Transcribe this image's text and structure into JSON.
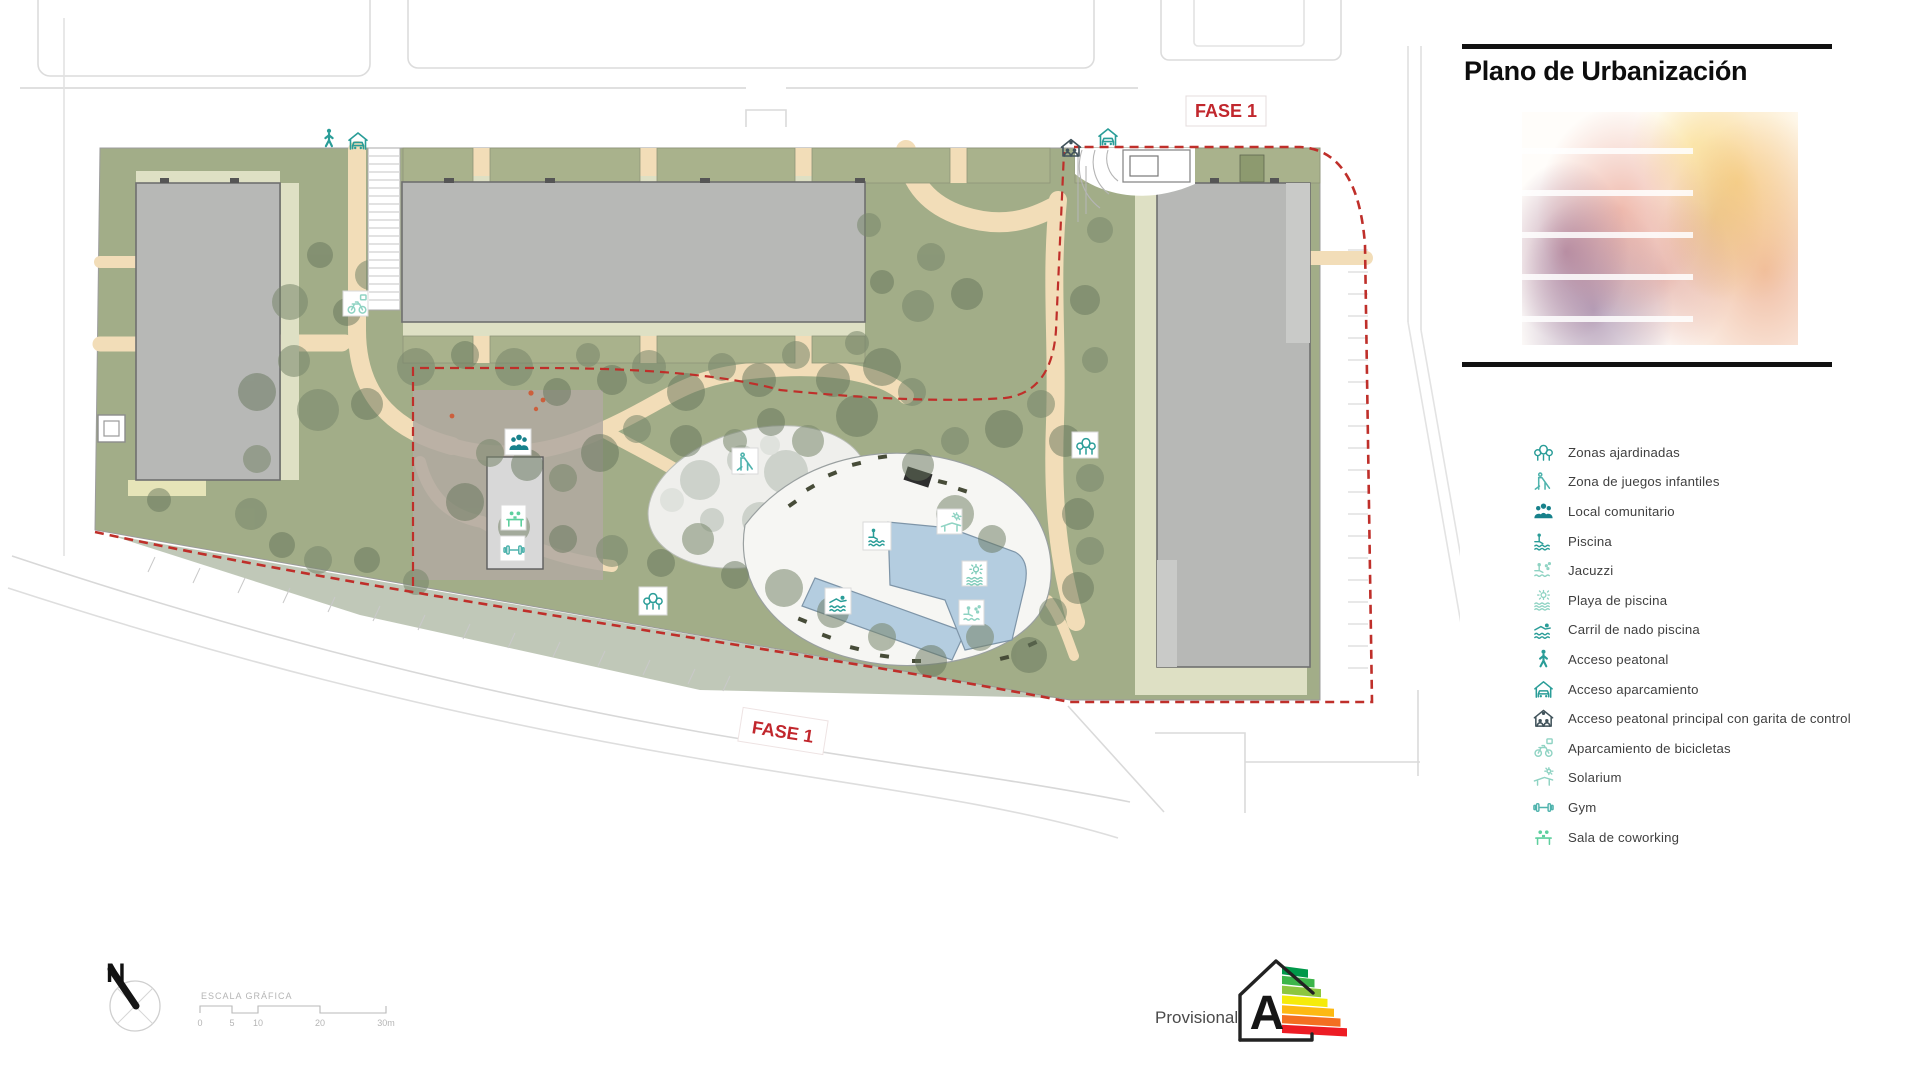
{
  "panel": {
    "title": "Plano de Urbanización"
  },
  "plan": {
    "fase_label": "FASE 1"
  },
  "legend": {
    "items": [
      {
        "icon": "trees-icon",
        "label": "Zonas ajardinadas"
      },
      {
        "icon": "playground-slide-icon",
        "label": "Zona de juegos infantiles"
      },
      {
        "icon": "people-group-icon",
        "label": "Local comunitario"
      },
      {
        "icon": "pool-person-icon",
        "label": "Piscina"
      },
      {
        "icon": "jacuzzi-icon",
        "label": "Jacuzzi"
      },
      {
        "icon": "sun-waves-icon",
        "label": "Playa de piscina"
      },
      {
        "icon": "swimmer-icon",
        "label": "Carril de nado piscina"
      },
      {
        "icon": "pedestrian-icon",
        "label": "Acceso peatonal"
      },
      {
        "icon": "carport-icon",
        "label": "Acceso aparcamiento"
      },
      {
        "icon": "guardhouse-icon",
        "label": "Acceso peatonal principal con garita de control"
      },
      {
        "icon": "bicycle-icon",
        "label": "Aparcamiento de bicicletas"
      },
      {
        "icon": "lounger-sun-icon",
        "label": "Solarium"
      },
      {
        "icon": "dumbbell-icon",
        "label": "Gym"
      },
      {
        "icon": "coworking-icon",
        "label": "Sala de coworking"
      }
    ]
  },
  "north": {
    "letter": "N"
  },
  "scalebar": {
    "title": "ESCALA GRÁFICA",
    "ticks": [
      "0",
      "5",
      "10",
      "20",
      "30m"
    ]
  },
  "energy": {
    "label": "Provisional",
    "rating": "A"
  },
  "palette": {
    "phase_red": "#c1272d",
    "garden_olive": "#a2ad88",
    "garden_pale": "#dee0c4",
    "path_tan": "#f2ddb8",
    "building_gray": "#b7b8b6",
    "pool_blue": "#b4cde0",
    "icon_teal": "#2a9d98",
    "icon_teal_dark": "#17818b",
    "icon_mint": "#5ecf9e",
    "icon_slate": "#41535b"
  }
}
